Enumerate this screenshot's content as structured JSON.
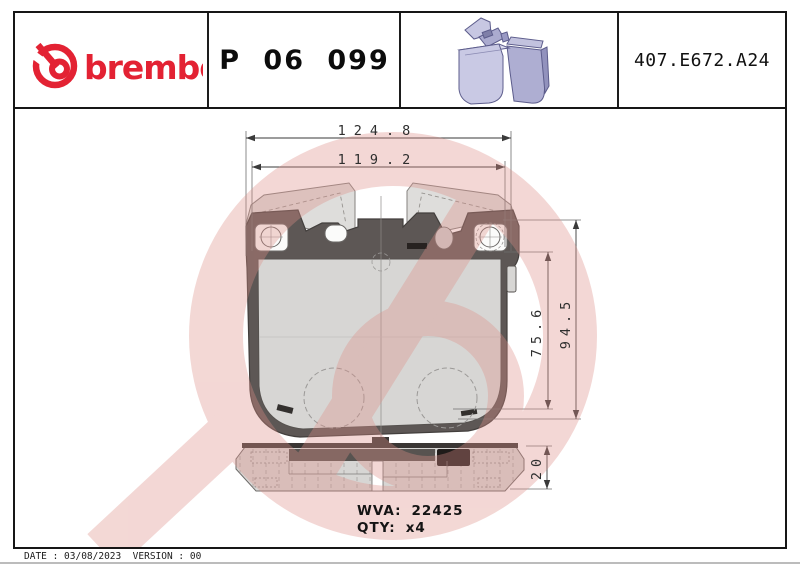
{
  "header": {
    "brand_wordmark": "brembo",
    "part_number": "P 06 099",
    "catalog_number": "407.E672.A24",
    "pad_render_icon": "brake-pads-3d-render"
  },
  "drawing": {
    "dimensions": {
      "width_outer": "124.8",
      "width_inner": "119.2",
      "height_outer": "94.5",
      "height_inner": "75.6",
      "thickness": "20"
    },
    "wva_label": "WVA:",
    "wva_value": "22425",
    "qty_label": "QTY:",
    "qty_value": "x4",
    "watermark_icon": "brembo-logo-watermark"
  },
  "footer": {
    "line": "DATE : 03/08/2023  VERSION : 00"
  },
  "colors": {
    "brand_red": "#e32233",
    "watermark_pink": "#f4d9d7",
    "backing_plate": "#5d5755",
    "friction_pad": "#d7d6d4",
    "render_lavender": "#b8b8da",
    "border_black": "#161616"
  }
}
